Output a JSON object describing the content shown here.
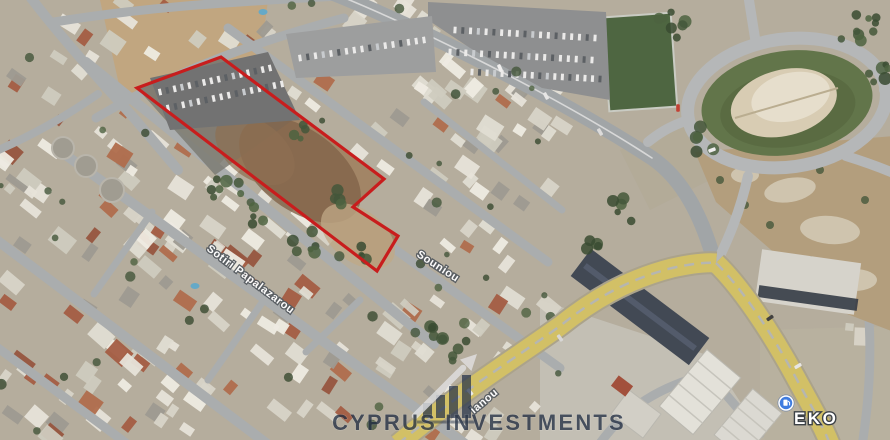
{
  "labels": {
    "papalazarou": "Sotiri Papalazarou",
    "souniou": "Souniou",
    "avenue_fragment": "ianou",
    "poi_eko": "EKO"
  },
  "watermark": {
    "brand": "CYPRUS INVESTMENTS"
  },
  "plot": {
    "points": "137,88 221,57 384,179 353,207 398,236 377,271",
    "outline_color": "#c81d1d",
    "fill": "#a08263"
  },
  "pin": {
    "color": "#3f7ce0"
  },
  "ground": {
    "base": "#b4ac9c",
    "patches": [
      {
        "pts": "100,0 268,0 258,78 122,98",
        "fill": "#c2a379",
        "op": 0.85
      },
      {
        "pts": "540,300 710,356 768,444 540,444",
        "fill": "#c3c1b8",
        "op": 0.9
      },
      {
        "pts": "760,330 894,326 894,444 760,444",
        "fill": "#b7b0a0",
        "op": 0.9
      },
      {
        "pts": "620,150 700,120 730,170 650,210",
        "fill": "#b0a894",
        "op": 0.6
      }
    ]
  },
  "roads": [
    {
      "d": "M28,-6 C55,30 92,72 134,118 L178,170",
      "w": 10
    },
    {
      "d": "M54,22 C160,5 240,2 338,-4",
      "w": 9
    },
    {
      "d": "M330,-8 C420,28 560,98 652,158 C684,180 702,218 714,260",
      "w": 15,
      "c": "#9fa4a7"
    },
    {
      "d": "M330,-8 C420,28 560,98 652,158",
      "w": 1.6,
      "c": "#d8dadb"
    },
    {
      "d": "M228,28 L548,262",
      "w": 9
    },
    {
      "d": "M86,62 L434,344",
      "w": 10
    },
    {
      "d": "M56,148 L468,446",
      "w": 10
    },
    {
      "d": "M-6,238 L270,446",
      "w": 10
    },
    {
      "d": "M-6,345 L130,446",
      "w": 9
    },
    {
      "d": "M346,214 L560,368",
      "w": 9
    },
    {
      "d": "M96,118 C180,68 262,40 344,18",
      "w": 9
    },
    {
      "d": "M-6,152 C40,132 72,112 98,94",
      "w": 8
    },
    {
      "d": "M152,212 L94,294",
      "w": 7
    },
    {
      "d": "M266,297 L208,380",
      "w": 7
    },
    {
      "d": "M424,102 L562,210",
      "w": 7
    },
    {
      "d": "M598,446 C626,406 662,386 708,374 L760,434",
      "w": 9
    },
    {
      "d": "M858,248 C872,300 874,370 862,446",
      "w": 9
    },
    {
      "d": "M306,352 L360,300",
      "w": 7
    }
  ],
  "features": {
    "field": {
      "cx": 640,
      "cy": 62,
      "w": 68,
      "h": 94,
      "rot": -4,
      "fill": "#47613b",
      "edge": "#c9ccc4"
    },
    "parkings": [
      {
        "pts": "428,2 606,12 610,100 542,88 470,48 428,20",
        "fill": "#8b8d8f",
        "rows": [
          [
            455,
            30,
            595,
            38
          ],
          [
            450,
            52,
            592,
            60
          ],
          [
            472,
            72,
            600,
            79
          ]
        ]
      },
      {
        "pts": "286,34 432,16 436,72 296,78",
        "fill": "#9a9c9e",
        "rows": [
          [
            300,
            58,
            424,
            40
          ]
        ]
      }
    ],
    "plot_parking": {
      "pts": "150,78 268,52 300,120 170,130",
      "fill": "#6d6e6f",
      "rows": [
        [
          160,
          92,
          270,
          68
        ],
        [
          168,
          108,
          282,
          84
        ]
      ]
    },
    "plot_patches": [
      {
        "type": "poly",
        "pts": "137,88 221,57 300,115 215,175",
        "fill": "#787871",
        "op": 0.85
      },
      {
        "type": "ell",
        "cx": 300,
        "cy": 170,
        "rx": 70,
        "ry": 40,
        "rot": 37,
        "fill": "#7d5f43",
        "op": 0.8
      },
      {
        "type": "ell",
        "cx": 255,
        "cy": 150,
        "rx": 45,
        "ry": 28,
        "rot": 37,
        "fill": "#8a6b4d",
        "op": 0.7
      },
      {
        "type": "ell",
        "cx": 358,
        "cy": 236,
        "rx": 42,
        "ry": 26,
        "rot": 37,
        "fill": "#bfa886",
        "op": 0.75
      }
    ],
    "tanks": [
      [
        63,
        148,
        11
      ],
      [
        86,
        166,
        11
      ],
      [
        112,
        190,
        12
      ]
    ],
    "pools": [
      [
        195,
        286
      ],
      [
        263,
        12
      ]
    ],
    "hill": {
      "pts": "695,152 894,136 894,332 842,312 762,242 716,202",
      "fill": "#b29c7b",
      "rocks": [
        [
          790,
          190,
          26,
          12,
          -10
        ],
        [
          830,
          230,
          30,
          14,
          5
        ],
        [
          745,
          175,
          14,
          8,
          0
        ],
        [
          855,
          280,
          22,
          11,
          0
        ]
      ],
      "shrubs": [
        [
          720,
          180
        ],
        [
          770,
          225
        ],
        [
          810,
          260
        ],
        [
          745,
          205
        ],
        [
          840,
          300
        ],
        [
          865,
          200
        ],
        [
          820,
          170
        ]
      ]
    },
    "roundabout": {
      "cx": 787,
      "cy": 103,
      "rot": -8,
      "grass_rx": 86,
      "grass_ry": 52,
      "mound_rx": 54,
      "mound_ry": 33,
      "ring_rx": 100,
      "ring_ry": 64,
      "exits": [
        "M748,176 C740,212 728,240 716,264",
        "M688,120 C668,127 658,134 648,142",
        "M755,38 L748,-6",
        "M884,90 L896,86",
        "M846,156 C872,164 886,170 896,174"
      ]
    },
    "dark_building": {
      "cx": 640,
      "cy": 307,
      "w": 148,
      "h": 34,
      "rot": 37,
      "fill": "#3a4350"
    },
    "white_building": {
      "cx": 808,
      "cy": 282,
      "w": 100,
      "h": 52,
      "rot": 8,
      "fill": "#d6d4cd",
      "stripe": "#2e3540"
    },
    "warehouses": [
      {
        "cx": 700,
        "cy": 392,
        "w": 74,
        "h": 44,
        "rot": -50,
        "fill": "#e4e3dc",
        "ribs": true
      },
      {
        "cx": 748,
        "cy": 424,
        "w": 60,
        "h": 38,
        "rot": -50,
        "fill": "#dcdbd4",
        "ribs": true
      },
      {
        "cx": 636,
        "cy": 414,
        "w": 40,
        "h": 30,
        "rot": 37,
        "fill": "#d2d0c8",
        "ribs": false
      }
    ],
    "red_roof": {
      "cx": 622,
      "cy": 386,
      "w": 18,
      "h": 13,
      "rot": 37,
      "fill": "#a04a36"
    }
  },
  "yellow_road": {
    "color": "#d2c063",
    "edge": "#a9a28a",
    "center": "#b5b6b0",
    "paths": [
      "M398,444 C460,392 520,355 560,326 C590,302 625,280 672,268 C690,264 706,262 716,263",
      "M716,263 C740,286 770,330 796,378 C810,404 822,424 830,444"
    ]
  },
  "cars": [
    [
      500,
      68,
      -25,
      "#f2f2f2"
    ],
    [
      546,
      96,
      -28,
      "#e8e8e8"
    ],
    [
      678,
      108,
      0,
      "#c23a2e"
    ],
    [
      600,
      132,
      -30,
      "#dddddd"
    ],
    [
      712,
      150,
      70,
      "#f0f0f0"
    ],
    [
      770,
      318,
      55,
      "#3a3a3a"
    ],
    [
      798,
      366,
      60,
      "#e8e8e8"
    ],
    [
      560,
      338,
      -35,
      "#d8d8d8"
    ],
    [
      470,
      392,
      -40,
      "#eeeeee"
    ]
  ],
  "buildings": {
    "regions": [
      {
        "x": 0,
        "y": 0,
        "w": 225,
        "h": 255,
        "n": 60,
        "rot": 37,
        "red": 0.18
      },
      {
        "x": 0,
        "y": 225,
        "w": 330,
        "h": 215,
        "n": 78,
        "rot": 37,
        "red": 0.3
      },
      {
        "x": 225,
        "y": 25,
        "w": 300,
        "h": 245,
        "n": 50,
        "rot": 37,
        "red": 0.12
      },
      {
        "x": 330,
        "y": 295,
        "w": 230,
        "h": 145,
        "n": 32,
        "rot": 37,
        "red": 0.15
      },
      {
        "x": 336,
        "y": 0,
        "w": 95,
        "h": 60,
        "n": 10,
        "rot": -53,
        "red": 0
      },
      {
        "x": 432,
        "y": 84,
        "w": 130,
        "h": 180,
        "n": 26,
        "rot": 37,
        "red": 0.08
      },
      {
        "x": 845,
        "y": 240,
        "w": 49,
        "h": 100,
        "n": 7,
        "rot": 5,
        "red": 0
      }
    ],
    "whites": [
      "#e8e5dc",
      "#e8e5dc",
      "#e2dfd5",
      "#d8d5ca",
      "#f0ede5",
      "#cfccc0",
      "#9b9890"
    ],
    "reds": [
      "#a2573e",
      "#94503a",
      "#ae6848"
    ]
  },
  "trees": {
    "clusters": [
      [
        668,
        30,
        20,
        7
      ],
      [
        858,
        30,
        24,
        9
      ],
      [
        874,
        78,
        16,
        6
      ],
      [
        700,
        140,
        14,
        5
      ],
      [
        225,
        185,
        16,
        7
      ],
      [
        305,
        245,
        14,
        6
      ],
      [
        345,
        195,
        10,
        4
      ],
      [
        262,
        215,
        10,
        4
      ],
      [
        300,
        130,
        9,
        4
      ],
      [
        370,
        255,
        9,
        4
      ],
      [
        455,
        350,
        14,
        6
      ],
      [
        430,
        330,
        10,
        4
      ],
      [
        620,
        210,
        12,
        5
      ],
      [
        590,
        240,
        10,
        4
      ]
    ],
    "scatter_n": 46,
    "seed": 12345
  }
}
